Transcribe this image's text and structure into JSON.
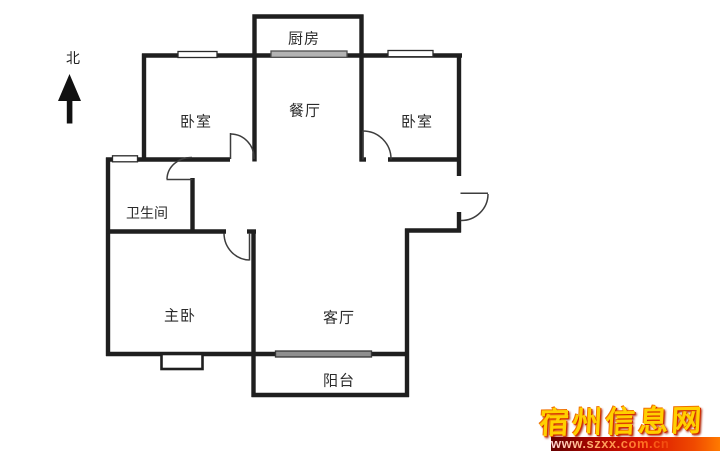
{
  "compass": {
    "label": "北"
  },
  "rooms": {
    "kitchen": {
      "label": "厨房"
    },
    "dining": {
      "label": "餐厅"
    },
    "bedroom_left": {
      "label": "卧室"
    },
    "bedroom_right": {
      "label": "卧室"
    },
    "bathroom": {
      "label": "卫生间"
    },
    "master_bedroom": {
      "label": "主卧"
    },
    "living_room": {
      "label": "客厅"
    },
    "balcony": {
      "label": "阳台"
    }
  },
  "watermark": {
    "site_name": "宿州信息网",
    "site_url": "www.szxx.com.cn"
  },
  "colors": {
    "background": "#ffffff",
    "wall": "#1f1f1f",
    "door": "#3d3d3d",
    "label_text": "#2b2b2b",
    "window_fill_white": "#ffffff",
    "window_fill_gray_kitchen": "#b3b3b3",
    "window_fill_gray_living": "#8f8f8f",
    "watermark_gold": "#ffd000",
    "watermark_banner_red": "#d81400"
  }
}
